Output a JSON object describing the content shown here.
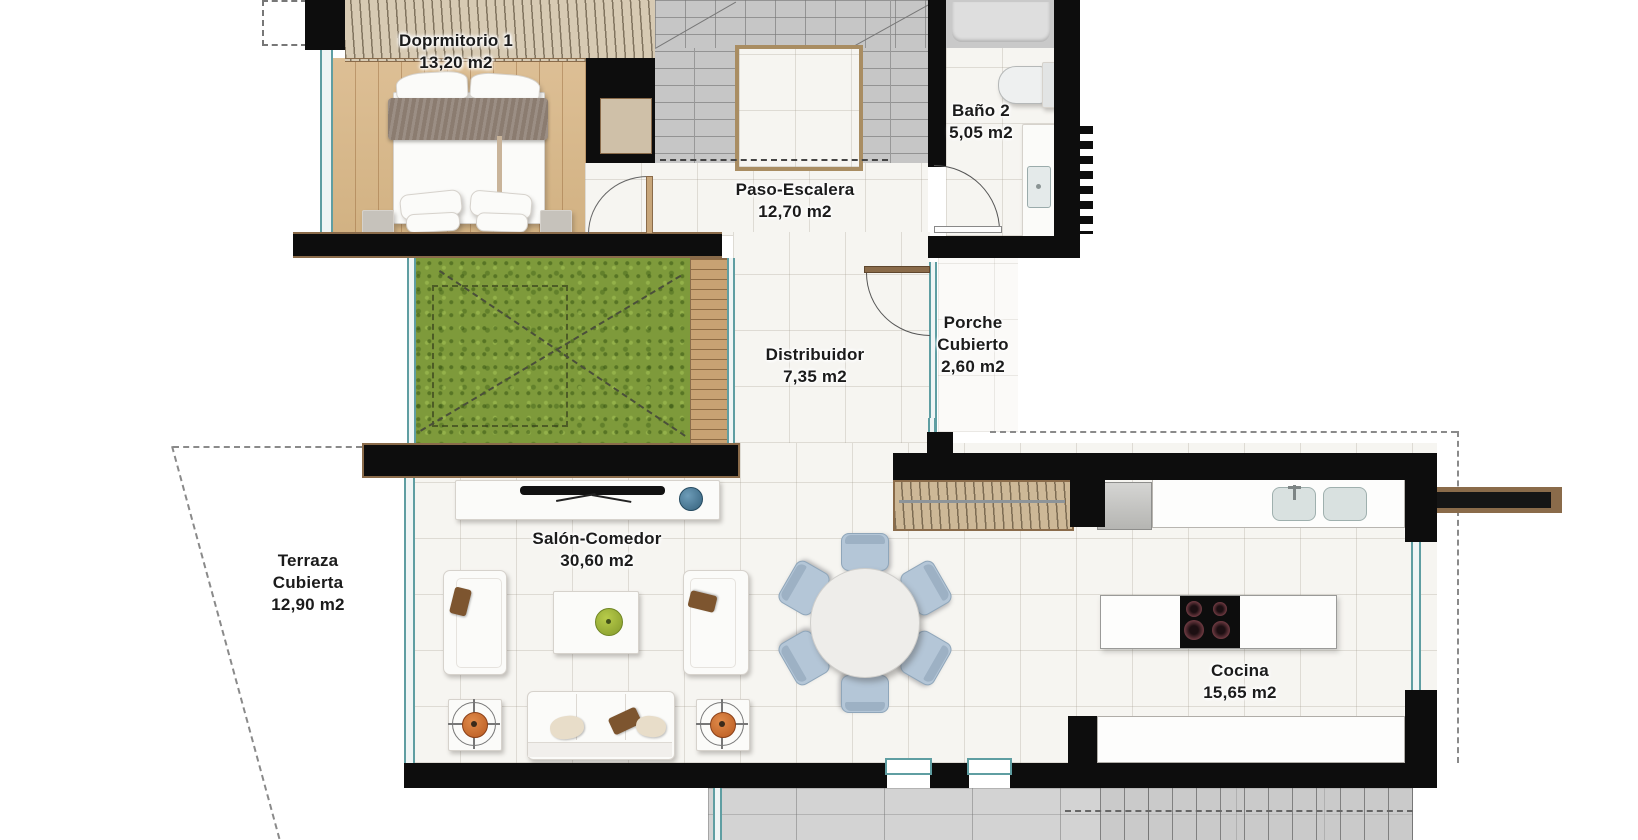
{
  "rooms": {
    "dormitorio1": {
      "label": "Doprmitorio 1",
      "area": "13,20 m2"
    },
    "bano2": {
      "label": "Baño 2",
      "area": "5,05 m2"
    },
    "paso_escalera": {
      "label": "Paso-Escalera",
      "area": "12,70 m2"
    },
    "distribuidor": {
      "label": "Distribuidor",
      "area": "7,35 m2"
    },
    "porche_cubierto": {
      "line1": "Porche",
      "line2": "Cubierto",
      "area": "2,60 m2"
    },
    "terraza_cubierta": {
      "line1": "Terraza",
      "line2": "Cubierta",
      "area": "12,90 m2"
    },
    "salon_comedor": {
      "label": "Salón-Comedor",
      "area": "30,60 m2"
    },
    "cocina": {
      "label": "Cocina",
      "area": "15,65 m2"
    }
  },
  "colors": {
    "wall": "#0d0d0d",
    "trim_brown": "#8a6b4a",
    "wood_floor": "#d8b98c",
    "closet_beige": "#d7cab3",
    "grass_green": "#7e9a3b",
    "deck_wood": "#c8a273",
    "marble_tile": "#f6f5f1",
    "stair_gray": "#c6c6c6",
    "window_teal": "#5f9ea2",
    "chair_blue": "#b4c6d7",
    "plant_orange": "#c9702e",
    "apple_green": "#9fb73a",
    "decor_blue": "#46778f",
    "cushion_brown": "#7d552f",
    "exterior_gray": "#d3d3d3"
  }
}
